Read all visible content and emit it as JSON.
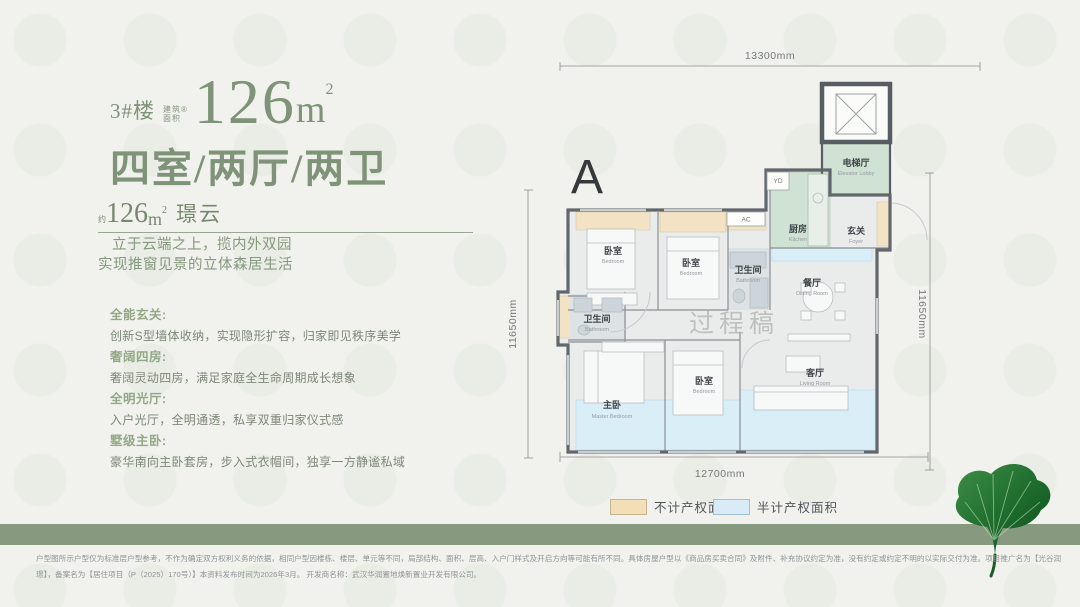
{
  "header": {
    "building": "3#楼",
    "area_note_line1": "建筑®",
    "area_note_line2": "面积",
    "area_value": "126",
    "area_unit_base": "m",
    "area_unit_sup": "2",
    "layout": "四室/两厅/两卫"
  },
  "subheader": {
    "prefix": "约",
    "area_value": "126",
    "area_unit_base": "m",
    "area_unit_sup": "2",
    "product_name": "璟云"
  },
  "intro": {
    "line1": "立于云端之上，揽内外双园",
    "line2": "实现推窗见景的立体森居生活"
  },
  "features": [
    {
      "title": "全能玄关:",
      "desc": "创新S型墙体收纳，实现隐形扩容，归家即见秩序美学"
    },
    {
      "title": "奢阔四房:",
      "desc": "奢阔灵动四房，满足家庭全生命周期成长想象"
    },
    {
      "title": "全明光厅:",
      "desc": "入户光厅，全明通透，私享双重归家仪式感"
    },
    {
      "title": "墅级主卧:",
      "desc": "豪华南向主卧套房，步入式衣帽间，独享一方静谧私域"
    }
  ],
  "floorplan": {
    "plan_label": "A",
    "watermark": "过程稿",
    "dimensions": {
      "top": "13300mm",
      "bottom": "12700mm",
      "left": "11650mm",
      "right": "11650mm"
    },
    "tags": {
      "yd": "YD",
      "ac": "AC"
    },
    "rooms": {
      "elevator_lobby": {
        "zh": "电梯厅",
        "en": "Elevator Lobby"
      },
      "kitchen": {
        "zh": "厨房",
        "en": "Kitchen"
      },
      "foyer": {
        "zh": "玄关",
        "en": "Foyer"
      },
      "bedroom_top_left": {
        "zh": "卧室",
        "en": "Bedroom"
      },
      "bedroom_top_mid": {
        "zh": "卧室",
        "en": "Bedroom"
      },
      "bathroom_mid": {
        "zh": "卫生间",
        "en": "Bathroom"
      },
      "dining": {
        "zh": "餐厅",
        "en": "Dining Room"
      },
      "bathroom_left": {
        "zh": "卫生间",
        "en": "Bathroom"
      },
      "master_bedroom": {
        "zh": "主卧",
        "en": "Master Bedroom"
      },
      "bedroom_bottom": {
        "zh": "卧室",
        "en": "Bedroom"
      },
      "living": {
        "zh": "客厅",
        "en": "Living Room"
      }
    }
  },
  "legend": [
    {
      "label": "不计产权面积",
      "color": "#f2dfb8"
    },
    {
      "label": "半计产权面积",
      "color": "#d8ebf7"
    }
  ],
  "footer": {
    "line1": "户型图所示户型仅为标准层户型参考，不作为确定双方权利义务的依据，相同户型因楼栋、楼层、单元等不同，局部结构、面积、层高、入户门样式及开启方向等可能有所不同。具体房屋户型以《商品房买卖合同》及附件、补充协议约定为准，没有约定或约定不明的以实际交付为准。项目推广名为【光谷润",
    "line2": "璟】，备案名为【居住项目（P（2025）170号）】本资料发布时间为2026年3月。 开发商名称：武汉华润置地焕新置业开发有限公司。"
  },
  "colors": {
    "accent_green": "#7e9377",
    "band_green": "#87997e",
    "not_counted_area": "#f2dfb8",
    "half_counted_area": "#d8ebf7",
    "kitchen_green": "#d0e2d4",
    "wall": "#61676b"
  }
}
